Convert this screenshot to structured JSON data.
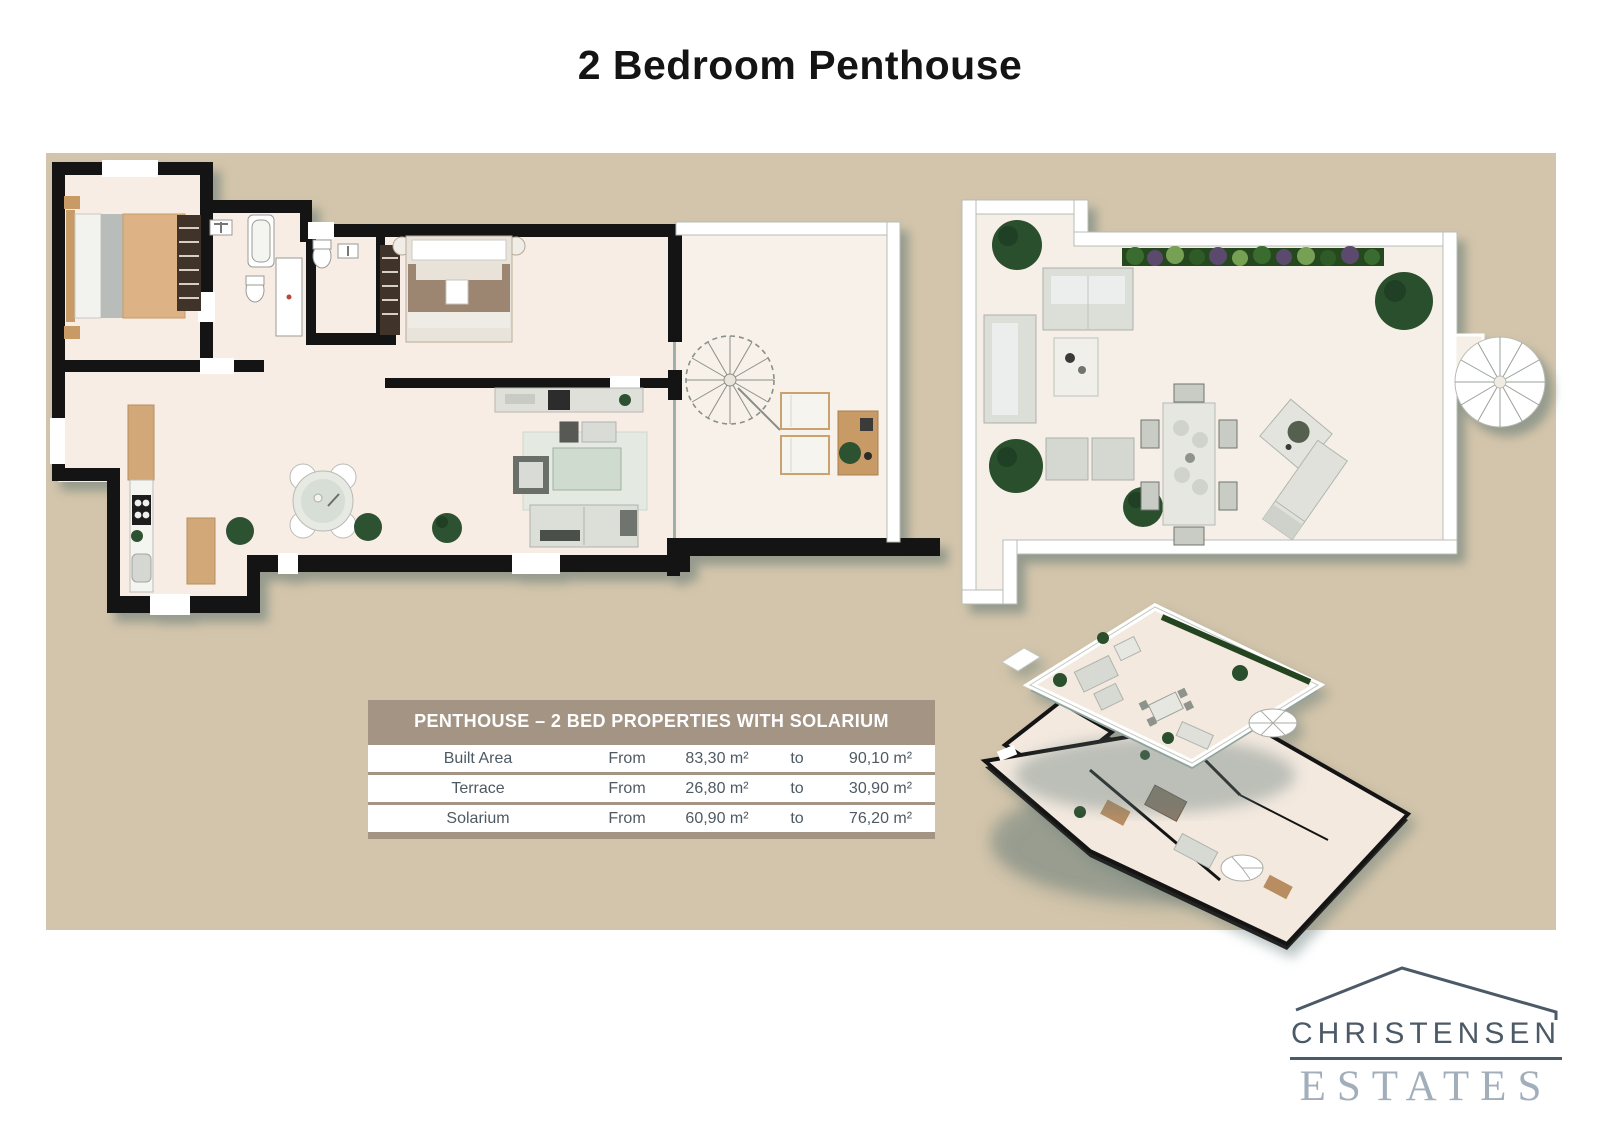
{
  "title": "2 Bedroom Penthouse",
  "table": {
    "header": "PENTHOUSE – 2 BED PROPERTIES WITH SOLARIUM",
    "rows": [
      {
        "label": "Built Area",
        "from_word": "From",
        "from_value": "83,30 m²",
        "to_word": "to",
        "to_value": "90,10 m²"
      },
      {
        "label": "Terrace",
        "from_word": "From",
        "from_value": "26,80 m²",
        "to_word": "to",
        "to_value": "30,90 m²"
      },
      {
        "label": "Solarium",
        "from_word": "From",
        "from_value": "60,90 m²",
        "to_word": "to",
        "to_value": "76,20 m²"
      }
    ]
  },
  "logo": {
    "name": "CHRISTENSEN",
    "type": "ESTATES"
  },
  "plans": {
    "main_floor": "main-penthouse-floorplan",
    "solarium": "solarium-floorplan",
    "isometric": "isometric-stacked-floors"
  },
  "colors": {
    "panel_beige": "#d3c5ab",
    "table_header": "#a39484",
    "floor_cream": "#f8ede4",
    "wall_black": "#141414",
    "logo_dark": "#4c5a67",
    "logo_light": "#a3aebb",
    "plant_green": "#2d5232"
  }
}
